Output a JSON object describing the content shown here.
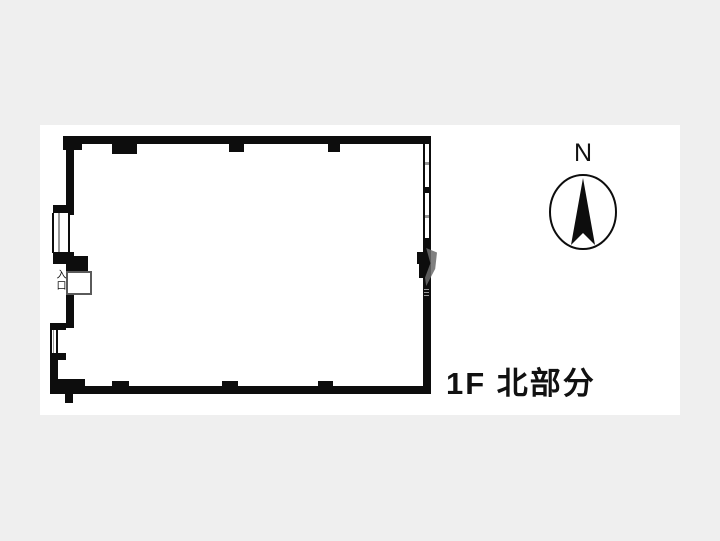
{
  "colors": {
    "bg": "#efefef",
    "card": "#ffffff",
    "wall": "#0d0d0d",
    "winline": "#999999",
    "door": "#5a5a5a",
    "wedge": "#6a6a6a",
    "text": "#111111"
  },
  "plan": {
    "title": "1F 北部分",
    "entrance_label": "入口"
  },
  "compass": {
    "north_label": "N"
  }
}
